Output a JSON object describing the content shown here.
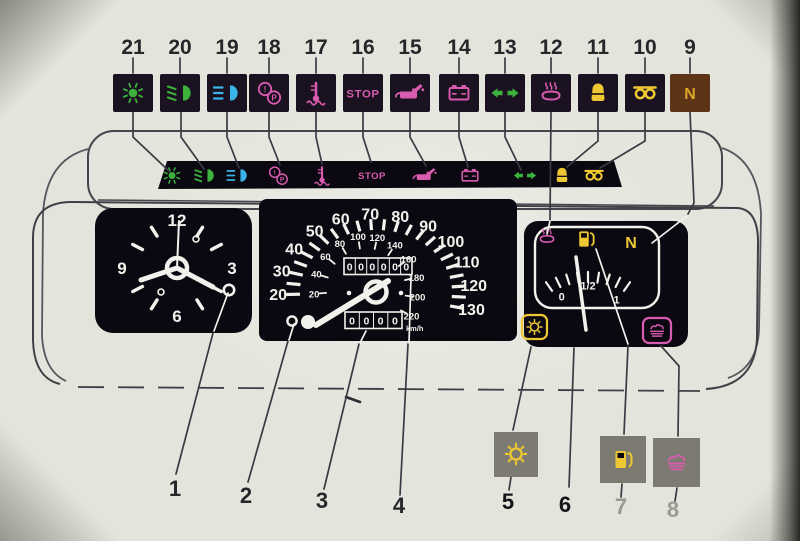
{
  "labels": {
    "stop": "STOP",
    "neutral": "N",
    "park": "P",
    "exclam": "!",
    "half": "1/2"
  },
  "top_row": [
    {
      "num": "21",
      "icon": "sidelights"
    },
    {
      "num": "20",
      "icon": "dipped-beam"
    },
    {
      "num": "19",
      "icon": "main-beam"
    },
    {
      "num": "18",
      "icon": "brake-warning"
    },
    {
      "num": "17",
      "icon": "coolant-temp"
    },
    {
      "num": "16",
      "icon": "stop"
    },
    {
      "num": "15",
      "icon": "oil-pressure"
    },
    {
      "num": "14",
      "icon": "battery"
    },
    {
      "num": "13",
      "icon": "turn-signals"
    },
    {
      "num": "12",
      "icon": "coolant-overheat"
    },
    {
      "num": "11",
      "icon": "choke"
    },
    {
      "num": "10",
      "icon": "glow-plugs"
    },
    {
      "num": "9",
      "icon": "neutral"
    }
  ],
  "strip_icons": [
    "sidelights",
    "dipped-beam",
    "main-beam",
    "brake-warning",
    "coolant-temp",
    "stop",
    "oil-pressure",
    "battery",
    "turn-signals",
    "choke",
    "glow-plugs"
  ],
  "clock": {
    "numbers": [
      "12",
      "3",
      "6",
      "9"
    ]
  },
  "speedometer": {
    "outer_scale": [
      "20",
      "30",
      "40",
      "50",
      "60",
      "70",
      "80",
      "90",
      "100",
      "110",
      "120",
      "130"
    ],
    "inner_scale": [
      "20",
      "40",
      "60",
      "80",
      "100",
      "120",
      "140",
      "160",
      "180",
      "200",
      "220"
    ],
    "inner_unit": "km/h",
    "odometer": "000000",
    "trip": "0000"
  },
  "fuel_gauge": {
    "scale": [
      "0",
      "1/2",
      "1"
    ],
    "top_icons": [
      "coolant-overheat",
      "fuel-pump",
      "neutral"
    ],
    "corner_icons": [
      "notched-circle",
      "heater"
    ]
  },
  "bottom_row": [
    {
      "num": "1"
    },
    {
      "num": "2"
    },
    {
      "num": "3"
    },
    {
      "num": "4"
    },
    {
      "num": "5",
      "icon": "notched-circle"
    },
    {
      "num": "6"
    },
    {
      "num": "7",
      "icon": "fuel-pump"
    },
    {
      "num": "8",
      "icon": "heater"
    }
  ],
  "colors": {
    "green": "#3cb23c",
    "blue": "#3ab4e8",
    "magenta": "#d95bb0",
    "yellow": "#eec832",
    "amber": "#d9a62a",
    "ink": "#26262b",
    "faint_ink": "#9b9992",
    "panel_black": "#0b0811",
    "square_dark": "#1a1220",
    "square_brown": "#5e3416",
    "square_grey": "#7d7b71",
    "white": "#f2f2ec",
    "outline": "#45454d"
  }
}
